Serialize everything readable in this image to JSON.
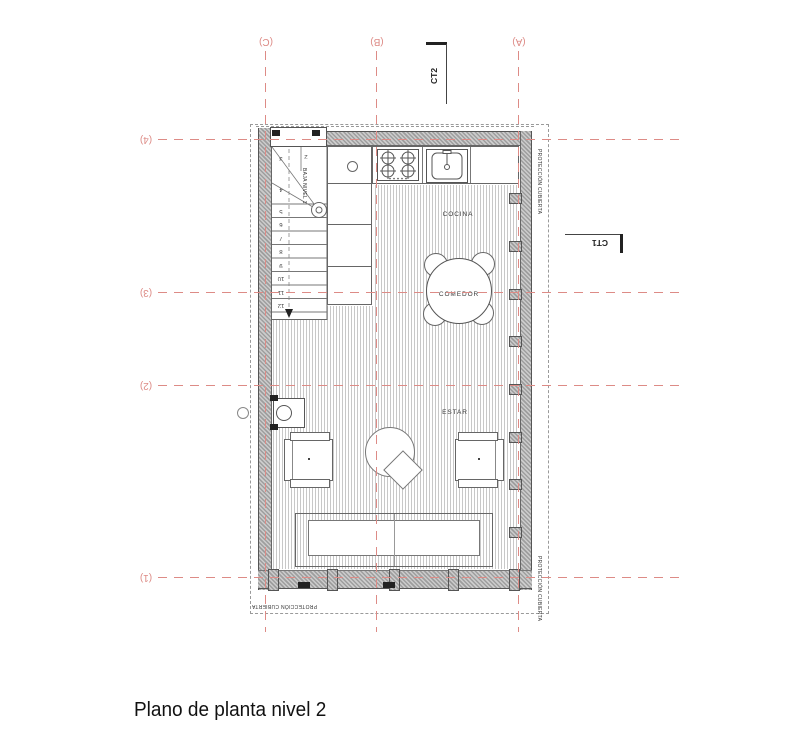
{
  "title": "Plano de planta nivel 2",
  "grid": {
    "cols": [
      "(C)",
      "(B)",
      "(A)"
    ],
    "rows": [
      "(4)",
      "(3)",
      "(2)",
      "(1)"
    ]
  },
  "rooms": {
    "cocina": "COCINA",
    "comedor": "COMEDOR",
    "estar": "ESTAR"
  },
  "stairs": {
    "note": "BAJA NIVEL 1",
    "numbers": [
      "2",
      "3",
      "4",
      "5",
      "6",
      "7",
      "8",
      "9",
      "10",
      "11",
      "12"
    ]
  },
  "sections": {
    "ct2": "CT2",
    "ct1": "CT1"
  },
  "roof_label": "PROTECCIÓN CUBIERTA",
  "colors": {
    "grid_red": "#dd8b86",
    "drawing_grey": "#555555",
    "hatch_grey": "#c8c8c8"
  }
}
